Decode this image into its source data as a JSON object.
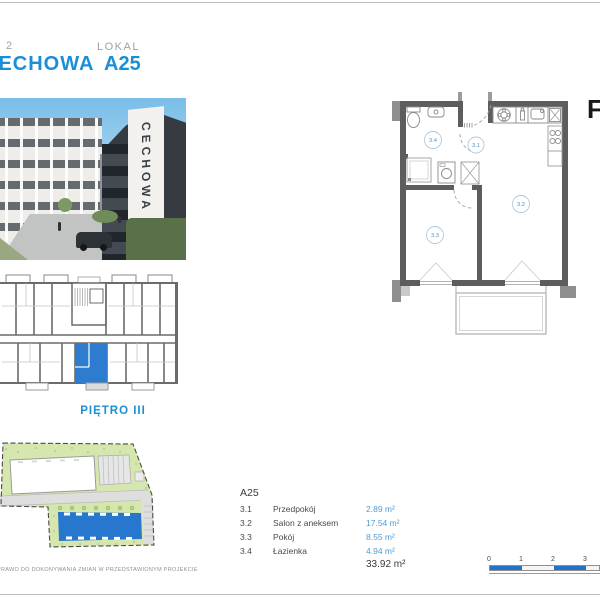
{
  "colors": {
    "accent_blue": "#1b8fd6",
    "unit_fill_blue": "#2d7cd0",
    "scalebar_blue": "#2472c8",
    "site_green": "#d5e7ae"
  },
  "header": {
    "etap_digit": "2",
    "project_name": "CECHOWA",
    "lokal_label": "LOKAL",
    "lokal_value": "A25"
  },
  "photo": {
    "sign": "CECHOWA"
  },
  "keyplan": {
    "floor_label": "PIĘTRO III"
  },
  "plan": {
    "rooms": {
      "hall": "3.1",
      "salon": "3.2",
      "room": "3.3",
      "bath": "3.4"
    },
    "edge_glyph": "F"
  },
  "legend": {
    "title": "A25",
    "rows": [
      {
        "no": "3.1",
        "name": "Przedpokój",
        "area": "2.89 m²"
      },
      {
        "no": "3.2",
        "name": "Salon z aneksem",
        "area": "17.54 m²"
      },
      {
        "no": "3.3",
        "name": "Pokój",
        "area": "8.55 m²"
      },
      {
        "no": "3.4",
        "name": "Łazienka",
        "area": "4.94 m²"
      }
    ],
    "total": "33.92 m²"
  },
  "scalebar": {
    "ticks": [
      "0",
      "1",
      "2",
      "3"
    ]
  },
  "disclaimer": "PRAWO DO DOKONYWANIA ZMIAN W PRZEDSTAWIONYM PROJEKCIE"
}
